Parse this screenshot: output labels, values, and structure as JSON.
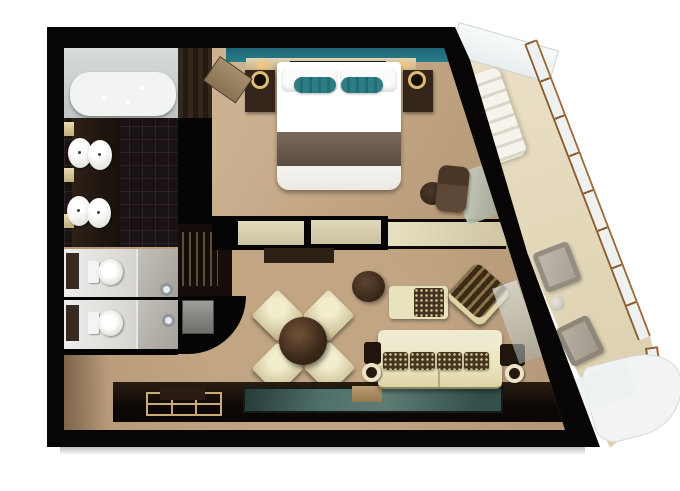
{
  "scene": {
    "title": "Suite floor plan — 3D top-down rendering",
    "background": "#ffffff",
    "no_visible_text": true
  },
  "palette": {
    "walls": "#070505",
    "bedroom_carpet": "#c9ae8e",
    "living_carpet": "#b79a7a",
    "accent_teal": "#2a7d8c",
    "rug_teal": "#4f6f69",
    "cream_upholstery": "#ece6bf",
    "walnut": "#34261a",
    "tub_water": "#bfe2d8",
    "balcony_floor": "#e7dcc0",
    "railing_frame": "#8a5a2f",
    "fixture_white": "#f4f4f2"
  },
  "rooms": {
    "bathroom": {
      "label": "Bathroom with tub and double vanity"
    },
    "bedroom": {
      "label": "Bedroom with king bed"
    },
    "toilet_1": {
      "label": "Water closet 1 with shower"
    },
    "toilet_2": {
      "label": "Water closet 2 with shower"
    },
    "living": {
      "label": "Living and dining room"
    },
    "corridor": {
      "label": "Entry corridor"
    },
    "balcony": {
      "label": "Private balcony with angled glass railing"
    }
  },
  "furniture": {
    "tub": {
      "label": "Bathtub"
    },
    "sinks": {
      "label": "Vanity sinks",
      "count": 4
    },
    "toilets": {
      "label": "Toilets",
      "count": 2
    },
    "showers": {
      "label": "Showers",
      "count": 2
    },
    "bed": {
      "label": "King bed with teal accent pillows"
    },
    "nightstands": {
      "label": "Nightstands with lamps",
      "count": 2
    },
    "wardrobe": {
      "label": "Wardrobe"
    },
    "closet_door": {
      "label": "Closet door ajar"
    },
    "minibar": {
      "label": "Minibar shelving with bottles"
    },
    "fridge": {
      "label": "Mini fridge"
    },
    "dining_table": {
      "label": "Round dining table"
    },
    "dining_chairs": {
      "label": "Dining chairs",
      "count": 4
    },
    "sofa": {
      "label": "Cream sofa with patterned cushions",
      "cushions": 4
    },
    "armchair": {
      "label": "Armchair with dark cushion"
    },
    "accent_chair": {
      "label": "Patterned accent chair"
    },
    "ottoman": {
      "label": "Round ottoman"
    },
    "tv_console": {
      "label": "TV console"
    },
    "credenza": {
      "label": "Credenza counter"
    },
    "console": {
      "label": "Console table with tray"
    },
    "rug": {
      "label": "Teal runner rug"
    },
    "desk": {
      "label": "Vanity desk, chair and stool"
    },
    "lounger": {
      "label": "Balcony lounger"
    },
    "balcony_chairs": {
      "label": "Balcony chairs",
      "count": 2
    },
    "balcony_table": {
      "label": "Balcony side table"
    }
  }
}
